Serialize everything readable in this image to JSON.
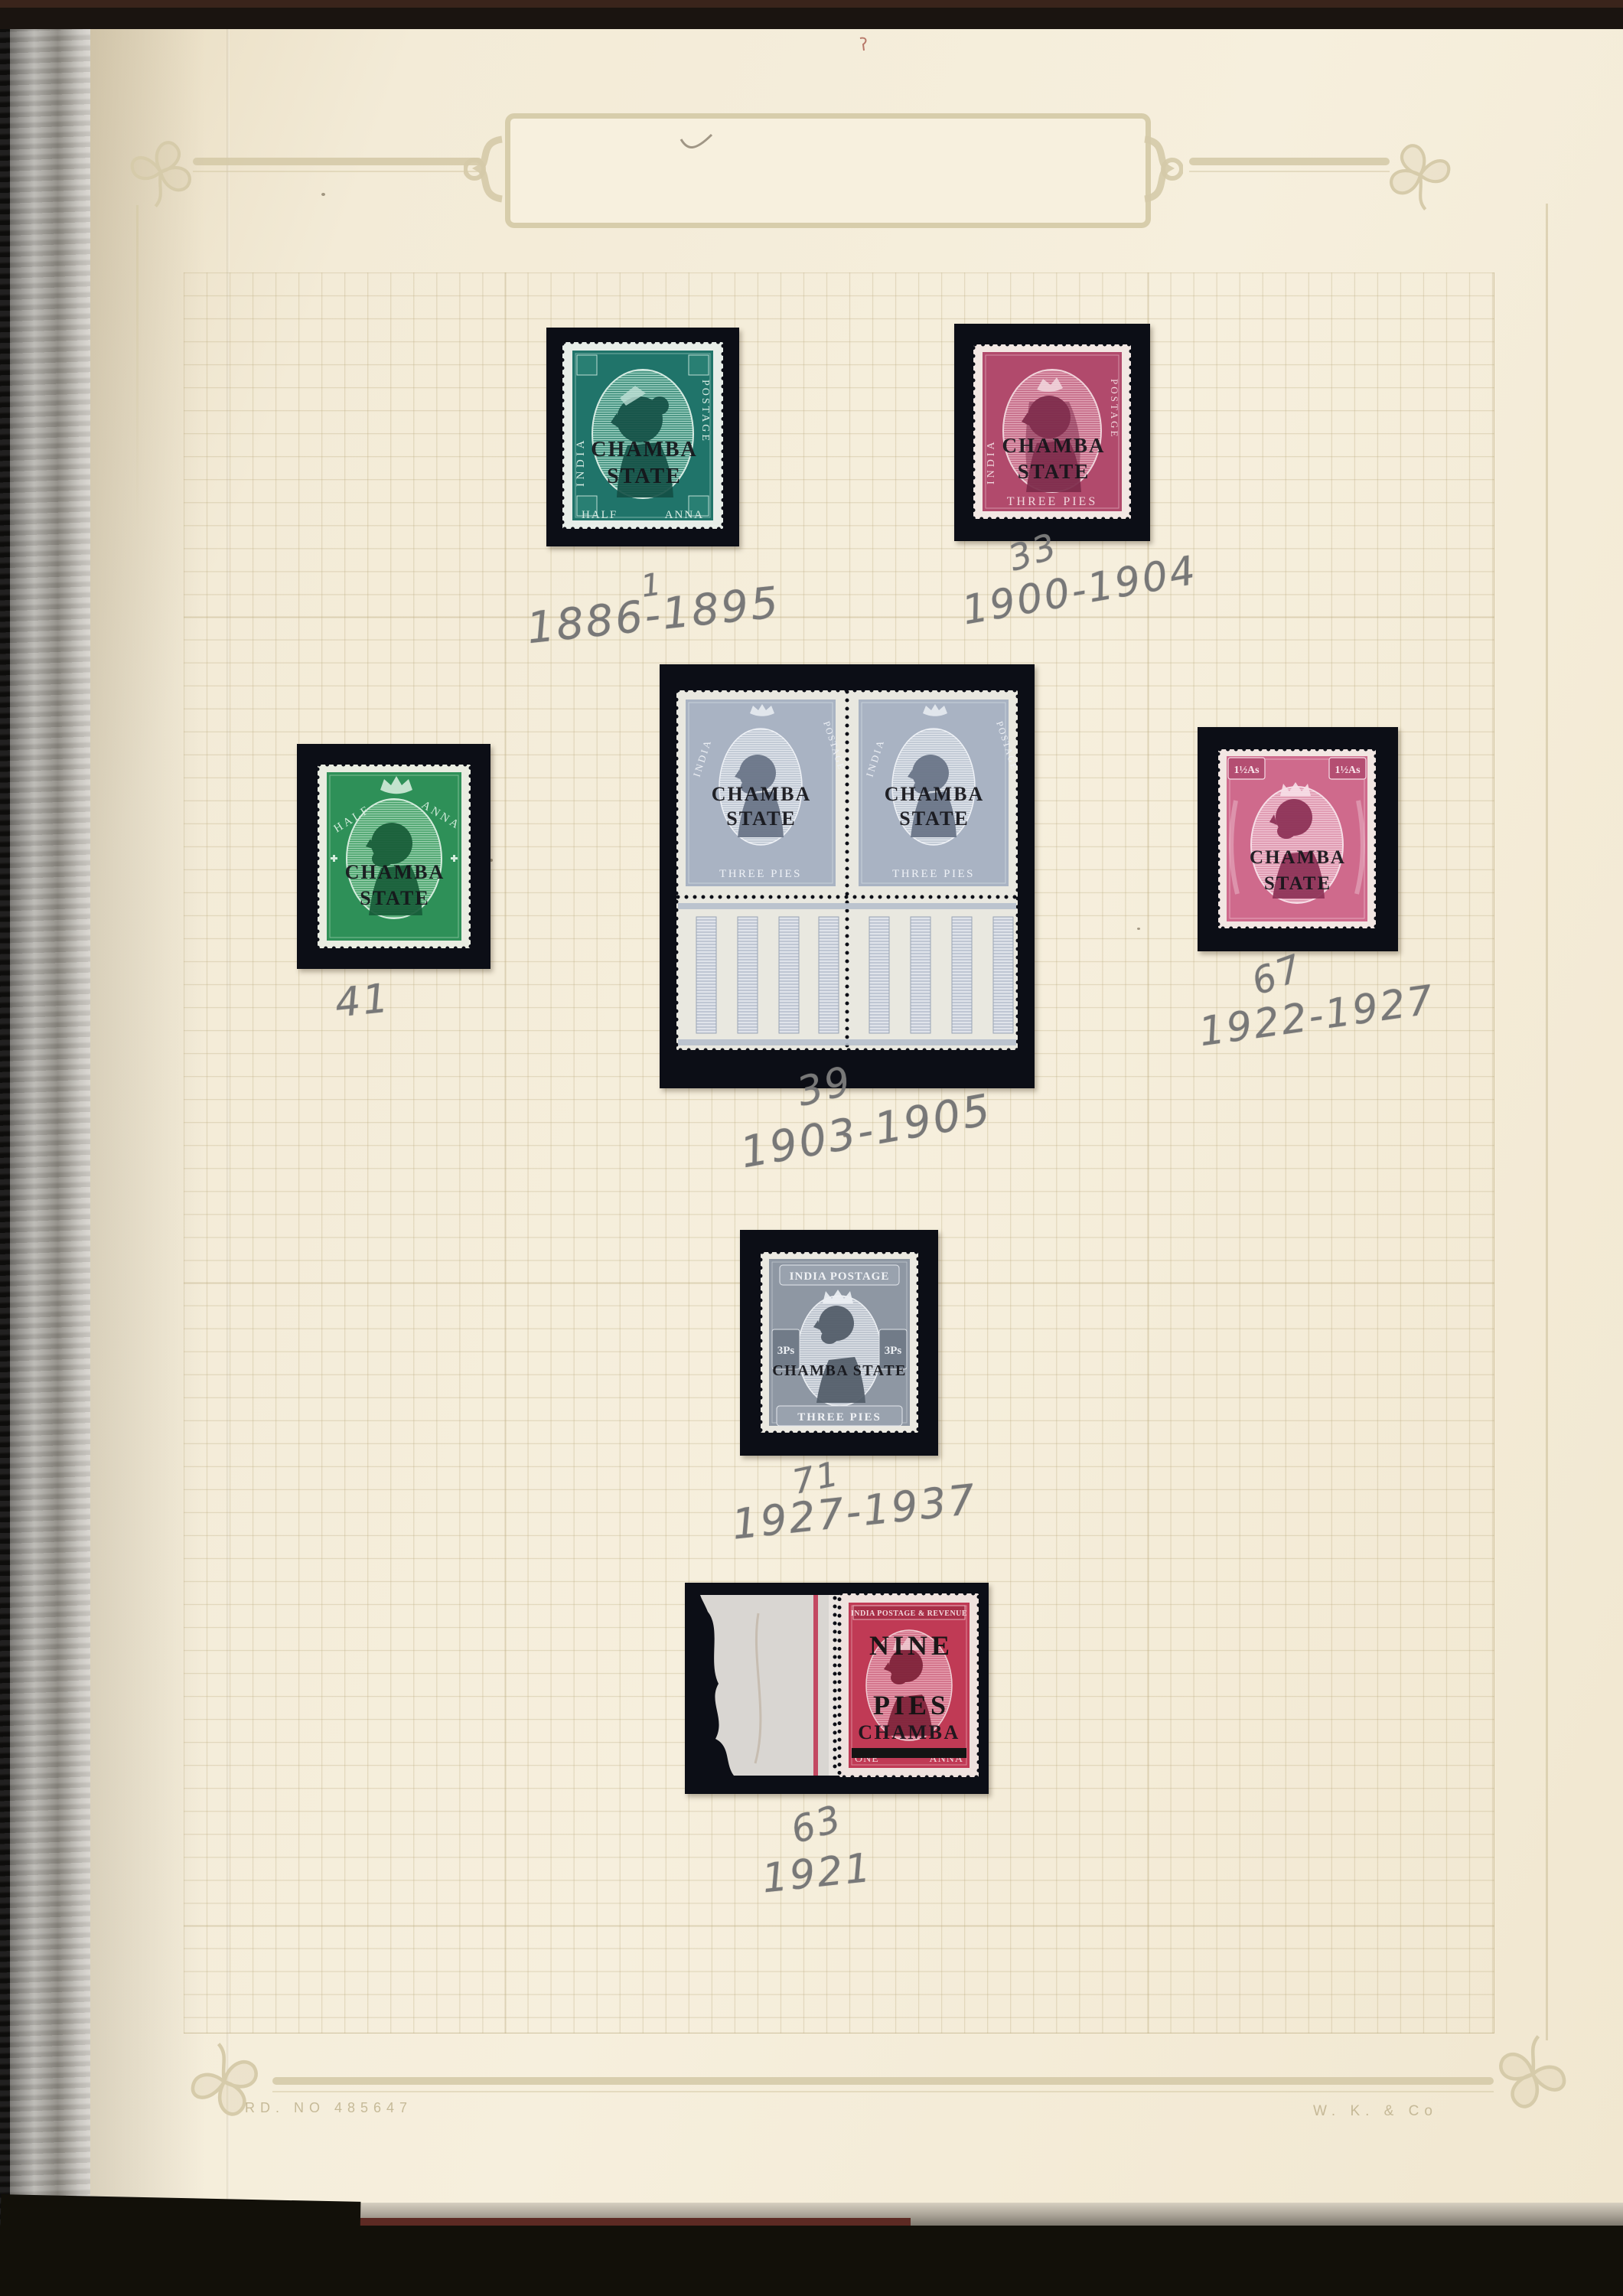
{
  "page": {
    "registration_mark": "RD. NO 485647",
    "maker_mark": "W. K. & Co"
  },
  "colors": {
    "mount_black": "#0c0e16",
    "page_cream": "#f3ebd7",
    "grid_line": "#b8a77a",
    "ornament_tan": "#d5caa8",
    "pencil_grey": "#787878",
    "qv_half_anna_teal": "#20746a",
    "qv_three_pies_carmine": "#b14a6c",
    "kevii_half_anna_green": "#2e9058",
    "kevii_three_pies_grey_blue": "#a9b3c3",
    "kgv_one_half_annas_rose": "#cf6a8c",
    "kgv_three_pies_grey": "#8e97a3",
    "kgv_one_anna_carmine": "#c03a55"
  },
  "stamps": {
    "qv_half_anna": {
      "side_left": "INDIA",
      "side_right": "POSTAGE",
      "bottom_left": "HALF",
      "bottom_right": "ANNA",
      "overprint_line1": "CHAMBA",
      "overprint_line2": "STATE",
      "number": "1",
      "dates": "1886-1895"
    },
    "qv_three_pies": {
      "side_left": "INDIA",
      "side_right": "POSTAGE",
      "bottom": "THREE PIES",
      "overprint_line1": "CHAMBA",
      "overprint_line2": "STATE",
      "number": "33",
      "dates": "1900-1904"
    },
    "kevii_half_anna": {
      "top_left": "HALF",
      "top_right": "ANNA",
      "bottom": "INDIA POSTAGE & REVENUE",
      "overprint_line1": "CHAMBA",
      "overprint_line2": "STATE",
      "number": "41"
    },
    "kevii_pair": {
      "top_left": "INDIA",
      "top_right": "POSTAGE",
      "bottom": "THREE PIES",
      "overprint_line1": "CHAMBA",
      "overprint_line2": "STATE",
      "number": "39",
      "dates": "1903-1905"
    },
    "kgv_one_and_half_annas": {
      "value_tablet": "1½As",
      "top": "INDIA POSTAGE",
      "bottom": "ONE AND A HALF ANNAS",
      "overprint_line1": "CHAMBA",
      "overprint_line2": "STATE",
      "number": "67",
      "dates": "1922-1927"
    },
    "kgv_three_pies": {
      "top": "INDIA POSTAGE",
      "value": "3Ps",
      "overprint": "CHAMBA STATE",
      "bottom": "THREE PIES",
      "number": "71",
      "dates": "1927-1937"
    },
    "kgv_nine_pies": {
      "top": "INDIA POSTAGE & REVENUE",
      "overprint_line1": "NINE",
      "overprint_line2": "PIES",
      "overprint_line3": "CHAMBA",
      "bottom_left": "ONE",
      "bottom_right": "ANNA",
      "number": "63",
      "dates": "1921"
    }
  }
}
